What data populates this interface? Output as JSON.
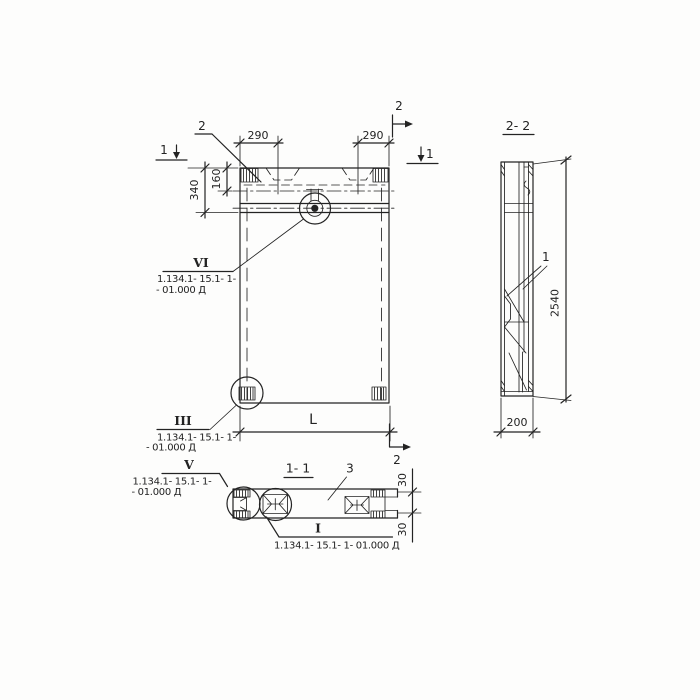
{
  "palette": {
    "paper": "#fdfdfc",
    "ink": "#232323"
  },
  "elevation": {
    "dims": {
      "left_290": "290",
      "right_290": "290",
      "v340": "340",
      "v160": "160",
      "length": "L"
    },
    "marks": {
      "sec1_left": "1",
      "sec1_right": "1",
      "sec2_top": "2",
      "sec2_bottom": "2",
      "item2": "2"
    }
  },
  "side": {
    "title": "2- 2",
    "item1": "1",
    "dim_height": "2540",
    "dim_width": "200"
  },
  "plan": {
    "title": "1- 1",
    "item3": "3",
    "dim30_top": "30",
    "dim30_bottom": "30"
  },
  "callouts": {
    "vi": {
      "num": "VI",
      "l1": "1.134.1- 15.1- 1-",
      "l2": "- 01.000 Д"
    },
    "iii": {
      "num": "III",
      "l1": "1.134.1- 15.1- 1-",
      "l2": "- 01.000 Д"
    },
    "v": {
      "num": "V",
      "l1": "1.134.1- 15.1- 1-",
      "l2": "- 01.000 Д"
    },
    "i": {
      "num": "I",
      "l1": "1.134.1- 15.1- 1- 01.000 Д"
    }
  }
}
